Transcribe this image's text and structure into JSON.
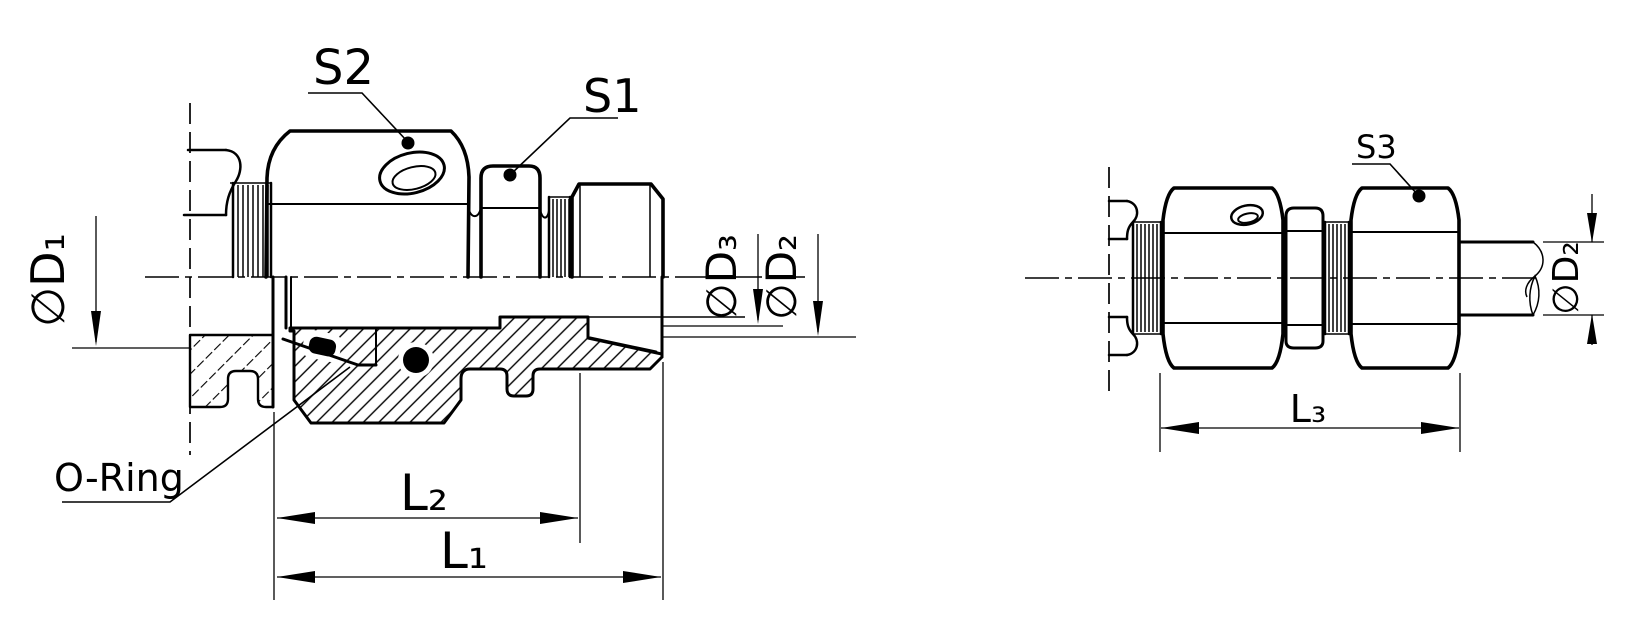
{
  "page": {
    "background": "#ffffff",
    "ink": "#000000"
  },
  "left_view": {
    "labels": {
      "s2": "S2",
      "s1": "S1",
      "o_ring": "O-Ring",
      "dia_d1": "∅D₁",
      "dia_d3": "∅D₃",
      "dia_d2": "∅D₂",
      "l2": "L₂",
      "l1": "L₁"
    }
  },
  "right_view": {
    "labels": {
      "s3": "S3",
      "dia_d2": "∅D₂",
      "l3": "L₃"
    }
  }
}
